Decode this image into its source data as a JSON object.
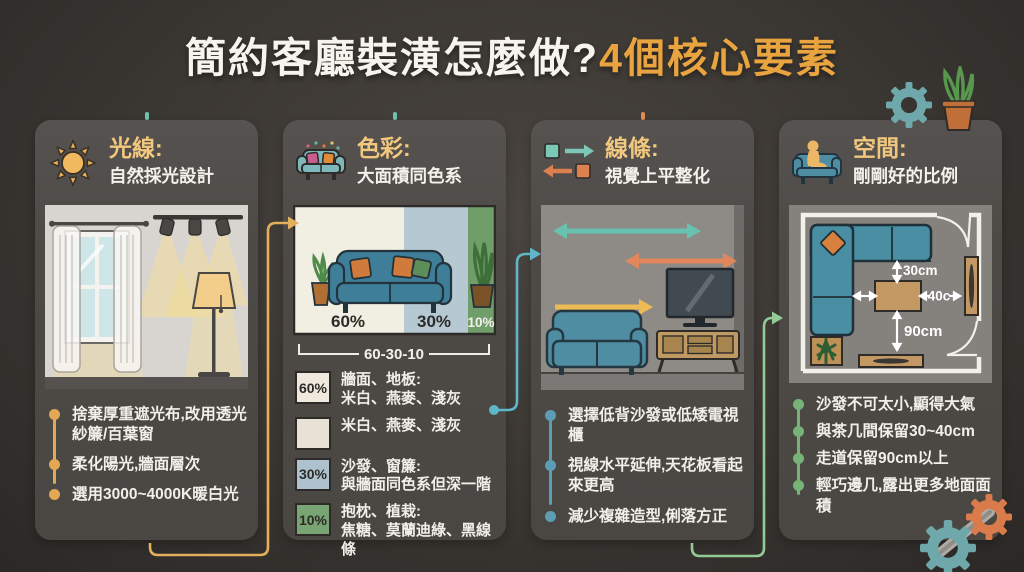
{
  "page": {
    "title": "簡約客廳裝潢怎麼做?",
    "title_accent": "4個核心要素"
  },
  "colors": {
    "background": "#3a3632",
    "card": "#4d4a46",
    "accent_orange": "#e9a440",
    "card_title_gold": "#f2c87e",
    "text_white": "#f4f1ec",
    "bullet_gold": "#e2a855",
    "bullet_blue": "#5d9cb5",
    "bullet_green": "#77b377",
    "connector_yellow": "#e2b05c",
    "connector_teal": "#5fb6c9",
    "connector_green": "#92cb95",
    "swatch_cream": "#eee9dc",
    "swatch_blue": "#adc2ce",
    "swatch_green": "#79a473",
    "sofa_teal": "#3e7e98",
    "wood_tan": "#c49862"
  },
  "cards": [
    {
      "icon": "sun-icon",
      "title": "光線:",
      "subtitle": "自然採光設計",
      "bullets": [
        "捨棄厚重遮光布,改用透光紗簾/百葉窗",
        "柔化陽光,牆面層次",
        "選用3000~4000K暖白光"
      ]
    },
    {
      "icon": "sofa-icon",
      "title": "色彩:",
      "subtitle": "大面積同色系"
    },
    {
      "icon": "squares-arrows-icon",
      "title": "線條:",
      "subtitle": "視覺上平整化",
      "bullets": [
        "選擇低背沙發或低矮電視櫃",
        "視線水平延伸,天花板看起來更高",
        "減少複雜造型,俐落方正"
      ]
    },
    {
      "icon": "person-sofa-icon",
      "title": "空間:",
      "subtitle": "剛剛好的比例",
      "bullets": [
        "沙發不可太小,顯得大氣",
        "與茶几間保留30~40cm",
        "走道保留90cm以上",
        "輕巧邊几,露出更多地面面積"
      ]
    }
  ],
  "color_card": {
    "chart": {
      "labels": [
        "60%",
        "30%",
        "10%"
      ],
      "caption": "60-30-10"
    },
    "legend": [
      {
        "badge": "60%",
        "line1": "牆面、地板:",
        "line2": "米白、燕麥、淺灰"
      },
      {
        "badge": "",
        "line1": "米白、燕麥、淺灰",
        "line2": ""
      },
      {
        "badge": "30%",
        "line1": "沙發、窗簾:",
        "line2": "與牆面同色系但深一階"
      },
      {
        "badge": "10%",
        "line1": "抱枕、植栽:",
        "line2": "焦糖、莫蘭迪綠、黑線條"
      }
    ]
  },
  "space_card": {
    "dims": {
      "sofa_table": "30cm",
      "table_wall": "40c",
      "walkway": "90cm"
    }
  },
  "chart_data": {
    "type": "bar",
    "title": "60-30-10",
    "categories": [
      "牆面、地板",
      "沙發、窗簾",
      "抱枕、植栽"
    ],
    "values": [
      60,
      30,
      10
    ],
    "unit": "%",
    "note": "interior color ratio rule"
  }
}
